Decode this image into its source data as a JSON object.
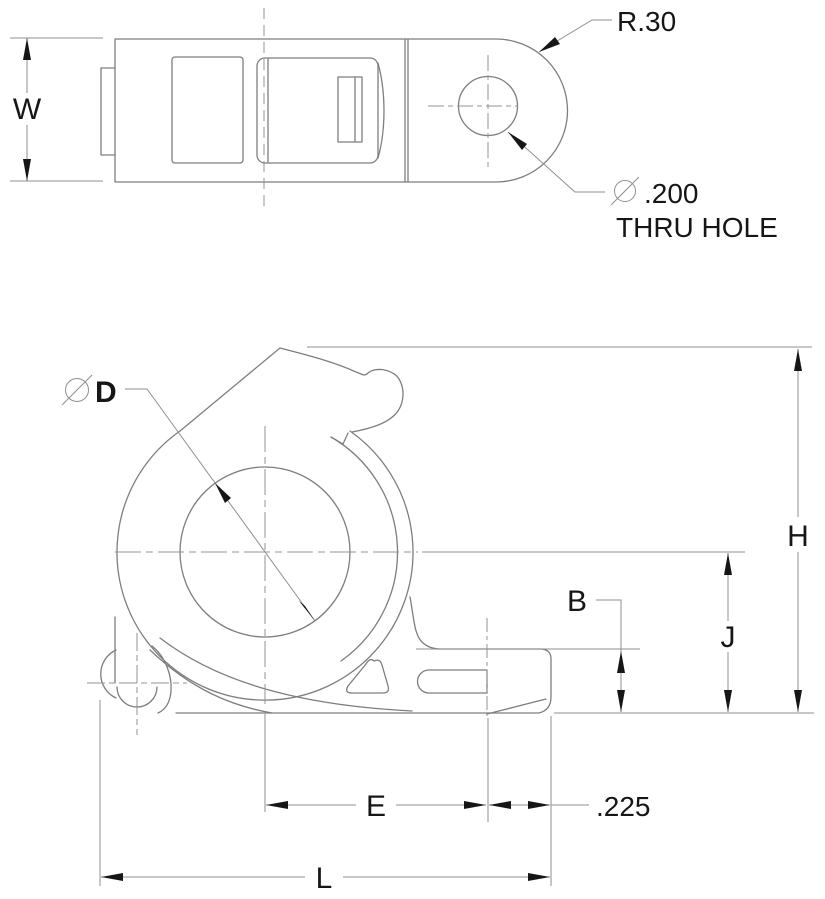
{
  "drawing": {
    "top_view": {
      "width_label": "W",
      "radius_callout": "R.30",
      "hole_callout_value": ".200",
      "hole_callout_note": "THRU HOLE"
    },
    "side_view": {
      "bore_label": "D",
      "height_label": "H",
      "mid_height_label": "J",
      "step_label": "B",
      "span_label": "E",
      "offset_value": ".225",
      "length_label": "L"
    },
    "colors": {
      "line": "#7e7e7e",
      "dimension": "#8f8f8f",
      "text": "#161616",
      "background": "#ffffff"
    }
  }
}
